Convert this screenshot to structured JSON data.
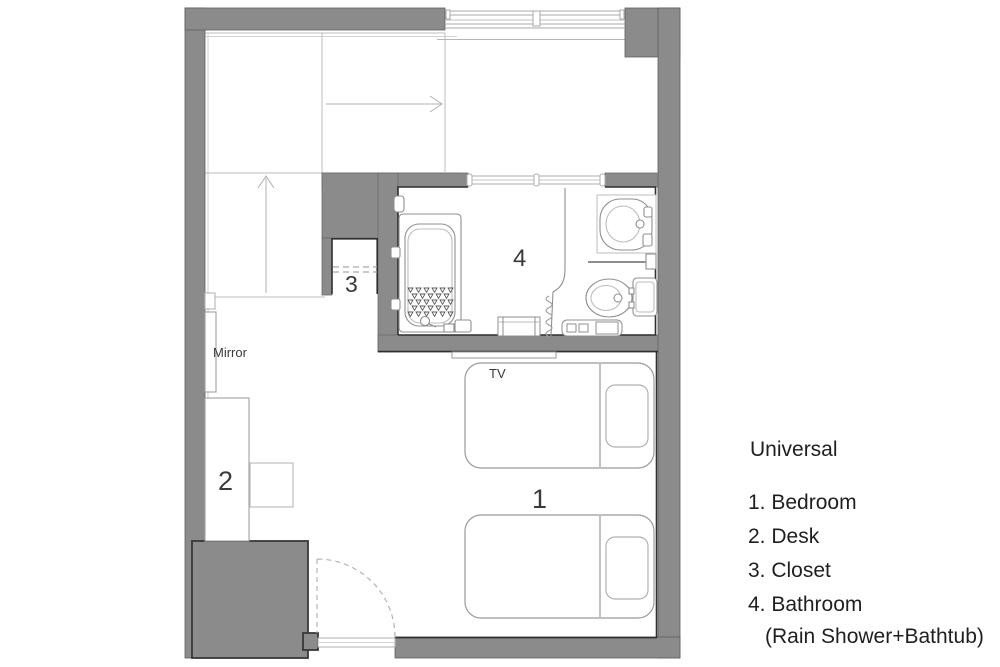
{
  "plan": {
    "room_labels": {
      "bedroom": "1",
      "desk": "2",
      "closet": "3",
      "bathroom": "4"
    },
    "annotations": {
      "mirror": "Mirror",
      "tv": "TV"
    }
  },
  "legend": {
    "title": "Universal",
    "items": [
      "1. Bedroom",
      "2. Desk",
      "3. Closet",
      "4. Bathroom"
    ],
    "bathroom_note": "(Rain Shower+Bathtub)"
  },
  "colors": {
    "wall_fill": "#8b8b8b",
    "wall_outline": "#3a3a3a",
    "bathroom_outline": "#2f2f2f",
    "fixture_line": "#8f8f8f",
    "guide_line": "#bdbdbd",
    "text": "#2b2b2b",
    "background": "#ffffff"
  }
}
